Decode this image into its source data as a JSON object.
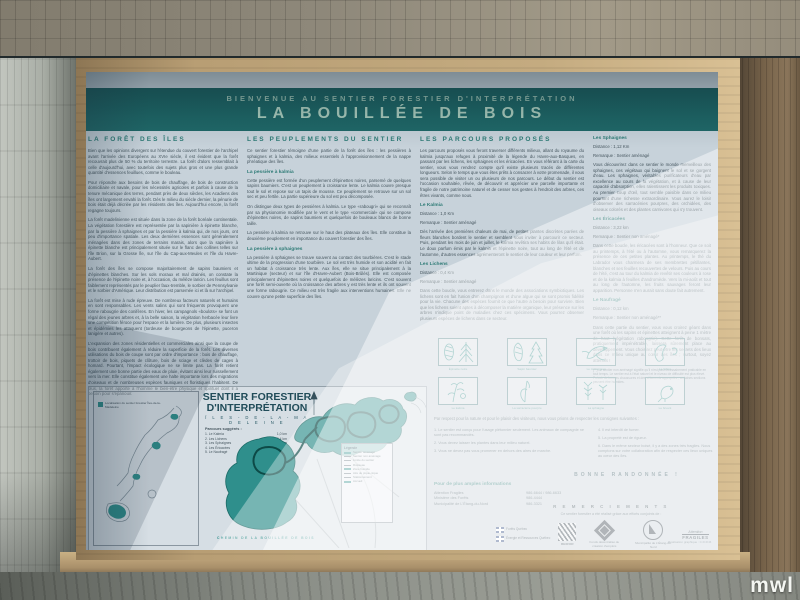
{
  "photo": {
    "watermark": "mwl"
  },
  "sign": {
    "banner": {
      "line1": "BIENVENUE AU SENTIER FORESTIER D'INTERPRÉTATION",
      "line2": "LA BOUILLÉE DE BOIS"
    },
    "col1": {
      "heading": "LA FORÊT DES ÎLES",
      "paragraphs": [
        "Bien que les opinions divergent sur l'étendue du couvert forestier de l'archipel avant l'arrivée des Européens au XVIe siècle, il est évident que la forêt recouvrait plus de 50 % du territoire terrestre. La forêt d'alors ressemblait à celle d'aujourd'hui, avec toutefois des sujets plus gros et une plus grande quantité d'essences feuillues, comme le bouleau.",
        "Pour répondre aux besoins de bois de chauffage, de bois de construction domiciliaire et navale, pour les nécessités agricoles et parfois à cause de la tenure mécanique des terres, pendant près de deux siècles, les Acadiens des îles ont largement envahi la forêt. Dès le milieu du siècle dernier, la pénurie de bois était déjà décriée par les résidents des îles. Aujourd'hui encore, la forêt regagne toujours.",
        "La forêt madelinienne est située dans la zone de la forêt boréale continentale. La végétation forestière est représentée par la sapinière à épinette blanche, par la pessière à sphaignes et par la pessière à kalmia qui, de nos jours, ont peu d'importance spatiale. Les deux dernières essences sont généralement ménagées dans des zones de terrains marais, alors que la sapinière à épinette blanche est principalement située sur le flanc des collines telles sur l'île Brion, sur la Grosse Île, sur l'île du Cap-aux-Meules et l'île du Havre-Aubert.",
        "La forêt des îles se compose majoritairement de sapins baumiers et d'épinettes blanches. Sur les sols moraux et mal drainés, on constate la présence de l'épinette noire et, à l'occasion, du mélèze laricin. Les feuillus sont faiblement représentés par le peuplier faux-tremble, le sorbier de Pennsylvanie et le sorbier d'Amérique. Leur distribution est parsemée ici et là sur l'archipel.",
        "La forêt est mise à rude épreuve. De nombreux facteurs naturels et humains en sont responsables. Les vents salins qui sont fréquents provoquent une forme rabougrie des conifères. En hiver, les campagnols «boulots» se font un régal des jeunes arbres et, à la belle saison, la végétation herbacée leur livre une compétition féroce pour l'espace et la lumière. De plus, plusieurs insectes et épidémies les attaquent (tordeuse de bourgeons de l'épinette, puceron lanigère et autres).",
        "L'expansion des zones résidentielles et commerciales ainsi que la coupe de bois contribuent également à réduire la superficie de la forêt. Les diverses utilisations du bois de coupe sont par ordre d'importance : bois de chauffage, trottoir de bois, piquets de clôture, bois de sciage et clèdes de cages à homard. Pourtant, l'impact écologique ne se limite pas. La forêt retient également une bonne partie des eaux de pluie, évitant ainsi leur ruissellement vers la mer. Elle constitue également une halte importante lors des migrations d'oiseaux et de nombreuses espèces fauniques et floristiques l'habitent. De plus, la forêt apporte à l'homme le bien-être physique et spirituel dont il a besoin pour s'épanouir."
      ]
    },
    "col2": {
      "heading": "LES PEUPLEMENTS DU SENTIER",
      "intro": "Ce sentier forestier témoigne d'une partie de la forêt des îles : les pessières à sphaignes et à kalmia, des milieux essentiels à l'approvisionnement de la nappe phréatique des îles.",
      "sub1_title": "La pessière à kalmia",
      "sub1_p1": "Cette pessière est formée d'un peuplement d'épinettes noires, parsemé de quelques sapins baumiers. C'est un peuplement à croissance lente. Le kalmia couvre presque tout le sol et repose sur un tapis de mousse. Ce peuplement se retrouve sur un sol sec et peu fertile. La partie supérieure du sol est peu décomposée.",
      "sub1_p2": "On distingue deux types de pessières à kalmia. Le type «rabougri» qui se reconnaît par sa physionomie modifiée par le vent et le type «commercial» qui se compose d'épinettes noires, de sapins baumiers et quelquefois de bouleaux blancs de bonne taille.",
      "sub1_p3": "La pessière à kalmia se retrouve sur le haut des plateaux des îles. Elle constitue la deuxième peuplement en importance du couvert forestier des îles.",
      "sub2_title": "La pessière à sphaignes",
      "sub2_p1": "La pessière à sphaignes se trouve souvent au contact des tourbières. C'est le stade ultime de la progression d'une tourbière. Le sol est très humide et son acidité en fait un habitat à croissance très lente. Aux îles, elle se situe principalement à la Martinique (secteur) et sur l'île d'Havre-Aubert (Bois-Brûlés). Elle est composée principalement d'épinettes noires et quelquefois de mélèzes laricins. C'est souvent une forêt semi-ouverte où la croissance des arbres y est très lente et ils ont souvent une forme rabougrie. Ce milieu est très fragile aux interventions humaines. Elle ne couvre qu'une petite superficie des îles."
    },
    "col3": {
      "heading": "LES PARCOURS PROPOSÉS",
      "intro": "Les parcours proposés vous feront traverser différents milieux, allant du royaume du kalmia jusqu'aux refuges à proximité de la légende du Havre-aux-Basques, en passant par les lichens, les sphaignes et les éricacées. En vous référant à la carte du sentier, vous vous rendrez compte qu'il existe plusieurs tracés de différentes longueurs. Selon le temps que vous êtes prêts à consacrer à votre promenade, il vous sera possible de visiter un ou plusieurs de nos parcours. Le début du sentier est l'occasion souhaitée, rêvée, de découvrir et apprécier une parcelle importante et fragile de notre patrimoine naturel et de cesser nos gestes à l'endroit des arbres, ces êtres vivants, comme nous.",
      "t1_name": "Le Kalmia",
      "t1_meta": "Distance : 1,0 Km",
      "t1_remark": "Remarque : Sentier aménagé",
      "t1_desc": "Dès l'arrivée des premières chaleurs de mai, de petites plantes discrètes parées de fleurs blanches bordent le sentier et semblent vous inviter à parcourir ce secteur. Puis, pendant les mois de juin et juillet, le kalmia revêtira ses habits de lilas qu'il était. Le doux parfum émis par le kalmia et l'épinette noire, tout au long de l'été et de l'automne, d'autres essences agrémenteront le sentier de leur couleur et leur parfum.",
      "t2_name": "Les Lichens",
      "t2_meta": "Distance : 0,4 Km",
      "t2_remark": "Remarque : Sentier aménagé",
      "t2_desc": "Dans cette boucle, vous entrerez dans le monde des associations symbiotiques. Les lichens sont en fait l'union d'un champignon et d'une algue qui se sont promis fidélité pour la vie. Chacune des espèces fournit ce que l'autre a besoin pour survivre. Bien que les lichens soient aptes à décomposer la matière organique, leur présence sur les arbres n'indique point de maladies chez ces spécimens. Vous pourrez observer plusieurs espèces de lichens dans ce secteur."
    },
    "col4": {
      "t1_name": "Les Sphaignes",
      "t1_meta": "Distance : 1,12 Km",
      "t1_remark": "Remarque : Sentier aménagé",
      "t1_desc": "Vous découvrirez dans ce sentier le monde merveilleux des sphaignes, ces végétaux qui baignent le sol et se gorgent d'eau. Les sphaignes, véritables purificateurs d'eau par excellence au cours de la végétation, et à cause de leur capacité d'absorption, elles ralentissent les produits toxiques. Au premier coup d'œil, tout semble paisible dans ce milieu pourtant d'une richesse extraordinaire. Vous aurez le loisir d'observer des sarracénies pourpres, des orchidées, des oiseaux colorés et des plantes carnivores qui s'y trouvent.",
      "t2_name": "Les Éricacées",
      "t2_meta": "Distance : 3,22 km",
      "t2_remark": "Remarque : Sentier non aménagé*",
      "t2_desc": "Dans cette boucle, les éricacées sont à l'honneur. Que ce soit au printemps, à l'été ou à l'automne, vous remarquerez la présence de ces petites plantes. Au printemps, le thé du Labrador vous charmera de ses membrettes pétillantes, blanches et ses feuilles recouvertes de velours. Puis au cours de l'été, c'est au tour du kalmia de revêtir ses couleurs à rose et de la kalmia à feuilles d'andromède. Vers la mi-août et tout au long de l'automne, les fruits sauvages feront leur apparition. Personne n'en aurait sans doute fait autrement.",
      "t3_name": "Le Naufragé",
      "t3_meta": "Distance : 0,12 km",
      "t3_remark": "Remarque : Sentier non aménagé**",
      "t3_desc": "Dans cette partie du sentier, vous vous croirez géant dans une forêt où les sapins et épinettes atteignent à peine 1 mètre de haut (végétation rabougrie). Cette forêt de bonsaïs, pratiquement impénétrable, laissera sûrement place au développement. Vous choisirez peut-être les secrets des lieux dans ce milieu unique au cœur des îles ; surtout, soyez attentifs !",
      "footnote": "(**) Le sentier non aménagé signifie qu'il n'est pas nécessairement praticable en tout temps. Le sentier est à l'état naturel et le niveau de difficulté est plus élevé. Prévoir de bonnes chaussures et des vêtements appropriés ; certaines sections peuvent être humides."
    },
    "species": {
      "row1": [
        "Épinette noire",
        "Sapin baumier",
        "Le mésangeai",
        "Le lichen"
      ],
      "row2": [
        "Le kalmia",
        "La sarracénie pourpre",
        "La sphaigne",
        "Le bruant"
      ]
    },
    "map": {
      "inset_caption": "Localisation du sentier forestier Îles-de-la-Madeleine",
      "title1": "SENTIER FORESTIER",
      "title2": "D'INTERPRÉTATION",
      "subtitle": "Î L E S - D E - L A - M A D E L E I N E",
      "routes_title": "Parcours suggérés :",
      "routes": [
        {
          "label": "1.  Le Kalmia",
          "dist": "1,0 km"
        },
        {
          "label": "2.  Les Lichens",
          "dist": "0,4 km"
        },
        {
          "label": "3.  Les Sphaignes",
          "dist": "1,12 km"
        },
        {
          "label": "4.  Les Éricacées",
          "dist": "3,22 km"
        },
        {
          "label": "5.  Le Naufragé",
          "dist": "0,12 km"
        }
      ],
      "legend_title": "Légende",
      "legend": [
        "Sentier aménagé",
        "Sentier non aménagé",
        "Limite du sentier",
        "Ruisseau",
        "Zone humide",
        "Aire de pique-nique",
        "Stationnement",
        "Accueil"
      ],
      "footer_label": "CHEMIN DE LA BOUILLÉE DE BOIS"
    },
    "rules": {
      "intro": "Par respect pour la nature et pour le plaisir des visiteurs, nous vous prions de respecter les consignes suivantes :",
      "left": [
        "1. Le sentier est conçu pour l'usage piétonnier seulement. Les animaux de compagnie ne sont pas recommandés.",
        "2. Vous devez laisser les plantes dans leur milieu naturel.",
        "3. Vous ne devez pas vous promener en dehors des aires de marche."
      ],
      "right": [
        "4. Il est interdit de fumer.",
        "5. La propreté est de rigueur.",
        "6. Dans le même secteur boisé, il y a des zones très fragiles. Nous comptons sur votre collaboration afin de respecter ces lieux uniques au cœur des îles."
      ],
      "bonne": "BONNE RANDONNÉE !"
    },
    "info": {
      "heading": "Pour de plus amples informations",
      "contacts": [
        {
          "name": "Attention Fragiles",
          "phone": "986-6644 / 986-6633"
        },
        {
          "name": "Ministère des Forêts",
          "phone": "986-4444"
        },
        {
          "name": "Municipalité de L'Étang-du-Nord",
          "phone": "986-3321"
        }
      ]
    },
    "credits": {
      "heading": "R E M E R C I E M E N T S",
      "line": "Ce sentier forestier a été réalisé grâce aux efforts conjoints de :",
      "gov1": "Forêts Québec",
      "gov2": "Énergie et Ressources Québec",
      "rexfor": "REXFOR",
      "fonds": "Fonds décentralisé de création d'emplois",
      "municipalite": "Municipalité de L'Étang-du-Nord",
      "fragiles_a": "Attention",
      "fragiles_b": "FRAGILES",
      "graphic": "Réalisation graphique : C.D.R.M."
    }
  }
}
